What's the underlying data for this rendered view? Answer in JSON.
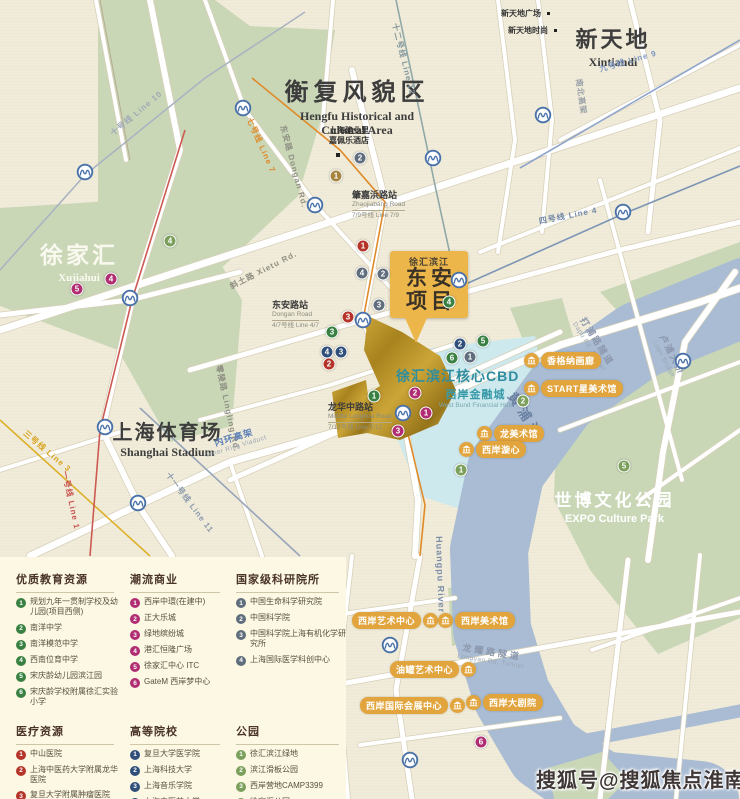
{
  "watermark": "搜狐号@搜狐焦点淮南站",
  "map": {
    "areas": {
      "hengfu": {
        "zh": "衡复风貌区",
        "en1": "Hengfu Historical and",
        "en2": "Cultural Area"
      },
      "xintiandi": {
        "zh": "新天地",
        "en": "Xintiandi"
      },
      "xujiahui": {
        "zh": "徐家汇",
        "en": "Xujiahui"
      },
      "stadium": {
        "zh": "上海体育场",
        "en": "Shanghai Stadium"
      },
      "expo": {
        "zh": "世博文化公园",
        "en": "EXPO Culture Park"
      },
      "cbd": {
        "zh": "徐汇滨江核心CBD"
      },
      "financial": {
        "zh": "西岸金融城",
        "en": "West Bund Financial Hub"
      }
    },
    "project": {
      "tag": "徐汇滨江",
      "line1": "东安",
      "line2": "项目"
    },
    "hotel": {
      "line1": "上海建业里",
      "line2": "嘉佩乐酒店",
      "x": 314,
      "y": 126
    },
    "pois_topright": [
      {
        "label": "新天地广场",
        "x": 501,
        "y": 8
      },
      {
        "label": "新天地时尚",
        "x": 508,
        "y": 25
      }
    ],
    "stations": [
      {
        "zh": "肇嘉浜路站",
        "en": "Zhaojiabang Road",
        "line": "7/9号线 Line 7/9",
        "x": 352,
        "y": 190
      },
      {
        "zh": "东安路站",
        "en": "Dongan Road",
        "line": "4/7号线 Line 4/7",
        "x": 272,
        "y": 300
      },
      {
        "zh": "龙华中路站",
        "en": "Middle Longhua Road",
        "line": "7/12号线 Line 7/12",
        "x": 328,
        "y": 402
      }
    ],
    "line_labels": [
      {
        "text": "十号线  Line 10",
        "x": 108,
        "y": 130,
        "rot": -40,
        "color": "#9fa9b6"
      },
      {
        "text": "七号线  Line 7",
        "x": 254,
        "y": 116,
        "rot": 66,
        "color": "#de8a2b"
      },
      {
        "text": "十二号线  Line 12",
        "x": 400,
        "y": 22,
        "rot": 76,
        "color": "#82989e"
      },
      {
        "text": "九号线  Line 9",
        "x": 598,
        "y": 64,
        "rot": -16,
        "color": "#8299c2"
      },
      {
        "text": "四号线  Line 4",
        "x": 538,
        "y": 216,
        "rot": -11,
        "color": "#7289a9"
      },
      {
        "text": "三号线  Line 3",
        "x": 28,
        "y": 428,
        "rot": 40,
        "color": "#d8a41f"
      },
      {
        "text": "一号线  Line 1",
        "x": 70,
        "y": 470,
        "rot": 78,
        "color": "#c75550"
      },
      {
        "text": "十一号线  Line 11",
        "x": 172,
        "y": 470,
        "rot": 53,
        "color": "#8b99ad"
      }
    ],
    "road_labels": [
      {
        "text": "东安路 Dongan Rd.",
        "x": 288,
        "y": 124,
        "rot": 75,
        "color": "#8f8f82"
      },
      {
        "text": "斜土路 Xietu Rd.",
        "x": 228,
        "y": 282,
        "rot": -27,
        "color": "#8f8f82"
      },
      {
        "text": "零陵路 Lingling Rd.",
        "x": 224,
        "y": 364,
        "rot": 78,
        "color": "#8f8f82"
      },
      {
        "text": "南北高架",
        "x": 584,
        "y": 78,
        "rot": 82,
        "color": "#9aa0a8"
      }
    ],
    "river_labels": [
      {
        "zh": "黄浦江",
        "en": "",
        "x": 520,
        "y": 388,
        "rot": 57,
        "size": 13,
        "color": "#6b81a3",
        "ls": 5
      },
      {
        "zh": "Huangpu River",
        "en": "",
        "x": 444,
        "y": 536,
        "rot": 88,
        "size": 9,
        "color": "#7b8da8",
        "ls": 1
      },
      {
        "zh": "打浦路隧道",
        "en": "Dapu Rd. Tunnel",
        "x": 588,
        "y": 314,
        "rot": 58,
        "size": 9,
        "color": "#8b97ac",
        "ls": 2
      },
      {
        "zh": "卢浦大桥",
        "en": "Lupu Bridge",
        "x": 668,
        "y": 332,
        "rot": 62,
        "size": 9,
        "color": "#8b97ac",
        "ls": 2
      },
      {
        "zh": "龙耀路隧道",
        "en": "Longyao Rd. Tunnel",
        "x": 460,
        "y": 640,
        "rot": 9,
        "size": 9,
        "color": "#8b97ac",
        "ls": 3
      },
      {
        "zh": "内环高架",
        "en": "Inner Ring Viaduct",
        "x": 202,
        "y": 440,
        "rot": -17,
        "size": 9,
        "color": "#5b7fb5",
        "ls": 1
      }
    ],
    "badges": [
      {
        "text": "香格纳画廊",
        "side": "left",
        "x": 524,
        "y": 352
      },
      {
        "text": "START星美术馆",
        "side": "left",
        "x": 524,
        "y": 380
      },
      {
        "text": "龙美术馆",
        "side": "left",
        "x": 477,
        "y": 425
      },
      {
        "text": "西岸漩心",
        "side": "left",
        "x": 459,
        "y": 441
      },
      {
        "text": "西岸艺术中心",
        "side": "right",
        "x": 352,
        "y": 612
      },
      {
        "text": "西岸美术馆",
        "side": "left",
        "x": 438,
        "y": 612
      },
      {
        "text": "油罐艺术中心",
        "side": "right",
        "x": 390,
        "y": 661
      },
      {
        "text": "西岸国际会展中心",
        "side": "right",
        "x": 360,
        "y": 697
      },
      {
        "text": "西岸大剧院",
        "side": "left",
        "x": 466,
        "y": 694
      }
    ],
    "markers": [
      {
        "n": "1",
        "x": 363,
        "y": 246,
        "c": "#b5342a"
      },
      {
        "n": "3",
        "x": 348,
        "y": 317,
        "c": "#b5342a"
      },
      {
        "n": "2",
        "x": 329,
        "y": 364,
        "c": "#b5342a"
      },
      {
        "n": "3",
        "x": 332,
        "y": 332,
        "c": "#388142"
      },
      {
        "n": "1",
        "x": 374,
        "y": 396,
        "c": "#388142"
      },
      {
        "n": "4",
        "x": 449,
        "y": 302,
        "c": "#388142"
      },
      {
        "n": "6",
        "x": 452,
        "y": 358,
        "c": "#388142"
      },
      {
        "n": "5",
        "x": 483,
        "y": 341,
        "c": "#388142"
      },
      {
        "n": "4",
        "x": 362,
        "y": 273,
        "c": "#5f6d7d"
      },
      {
        "n": "2",
        "x": 383,
        "y": 274,
        "c": "#5f6d7d"
      },
      {
        "n": "3",
        "x": 379,
        "y": 305,
        "c": "#5f6d7d"
      },
      {
        "n": "1",
        "x": 470,
        "y": 357,
        "c": "#5f6d7d"
      },
      {
        "n": "2",
        "x": 360,
        "y": 158,
        "c": "#5f6d7d"
      },
      {
        "n": "4",
        "x": 327,
        "y": 352,
        "c": "#2f4f7a"
      },
      {
        "n": "3",
        "x": 341,
        "y": 352,
        "c": "#2f4f7a"
      },
      {
        "n": "2",
        "x": 460,
        "y": 344,
        "c": "#2f4f7a"
      },
      {
        "n": "4",
        "x": 111,
        "y": 279,
        "c": "#b02d72"
      },
      {
        "n": "5",
        "x": 77,
        "y": 289,
        "c": "#b02d72"
      },
      {
        "n": "2",
        "x": 415,
        "y": 393,
        "c": "#b02d72"
      },
      {
        "n": "1",
        "x": 426,
        "y": 413,
        "c": "#b02d72"
      },
      {
        "n": "3",
        "x": 398,
        "y": 431,
        "c": "#b02d72"
      },
      {
        "n": "6",
        "x": 481,
        "y": 742,
        "c": "#b02d72"
      },
      {
        "n": "4",
        "x": 170,
        "y": 241,
        "c": "#7ba05b"
      },
      {
        "n": "2",
        "x": 523,
        "y": 401,
        "c": "#7ba05b"
      },
      {
        "n": "5",
        "x": 624,
        "y": 466,
        "c": "#7ba05b"
      },
      {
        "n": "1",
        "x": 461,
        "y": 470,
        "c": "#7ba05b"
      },
      {
        "n": "1",
        "x": 336,
        "y": 176,
        "c": "#a5853f"
      }
    ],
    "metro_icons": [
      [
        85,
        172
      ],
      [
        130,
        298
      ],
      [
        105,
        427
      ],
      [
        138,
        503
      ],
      [
        243,
        108
      ],
      [
        315,
        205
      ],
      [
        433,
        158
      ],
      [
        543,
        115
      ],
      [
        623,
        212
      ],
      [
        459,
        280
      ],
      [
        363,
        320
      ],
      [
        403,
        413
      ],
      [
        390,
        645
      ],
      [
        410,
        760
      ],
      [
        683,
        361
      ]
    ]
  },
  "legend": {
    "sections": [
      {
        "title": "优质教育资源",
        "color": "#388142",
        "items": [
          "规划九年一贯制学校及幼儿园(项目西侧)",
          "南洋中学",
          "南洋模范中学",
          "西南位育中学",
          "宋庆龄幼儿园滨江园",
          "宋庆龄学校附属徐汇实验小学"
        ]
      },
      {
        "title": "潮流商业",
        "color": "#b02d72",
        "items": [
          "西岸中環(在建中)",
          "正大乐城",
          "绿地缤纷城",
          "港汇恒隆广场",
          "徐家汇中心 ITC",
          "GateM 西岸梦中心"
        ]
      },
      {
        "title": "国家级科研院所",
        "color": "#5f6d7d",
        "items": [
          "中国生命科学研究院",
          "中国科学院",
          "中国科学院上海有机化学研究所",
          "上海国际医学科创中心"
        ]
      },
      {
        "title": "医疗资源",
        "color": "#b5342a",
        "items": [
          "中山医院",
          "上海中医药大学附属龙华医院",
          "复旦大学附属肿瘤医院"
        ]
      },
      {
        "title": "高等院校",
        "color": "#2f4f7a",
        "items": [
          "复旦大学医学院",
          "上海科技大学",
          "上海音乐学院",
          "上海中医药大学"
        ]
      },
      {
        "title": "公园",
        "color": "#7ba05b",
        "items": [
          "徐汇滨江绿地",
          "滨江滑板公园",
          "西岸营地CAMP3399",
          "徐家汇公园",
          "世博文化公园"
        ]
      }
    ]
  }
}
